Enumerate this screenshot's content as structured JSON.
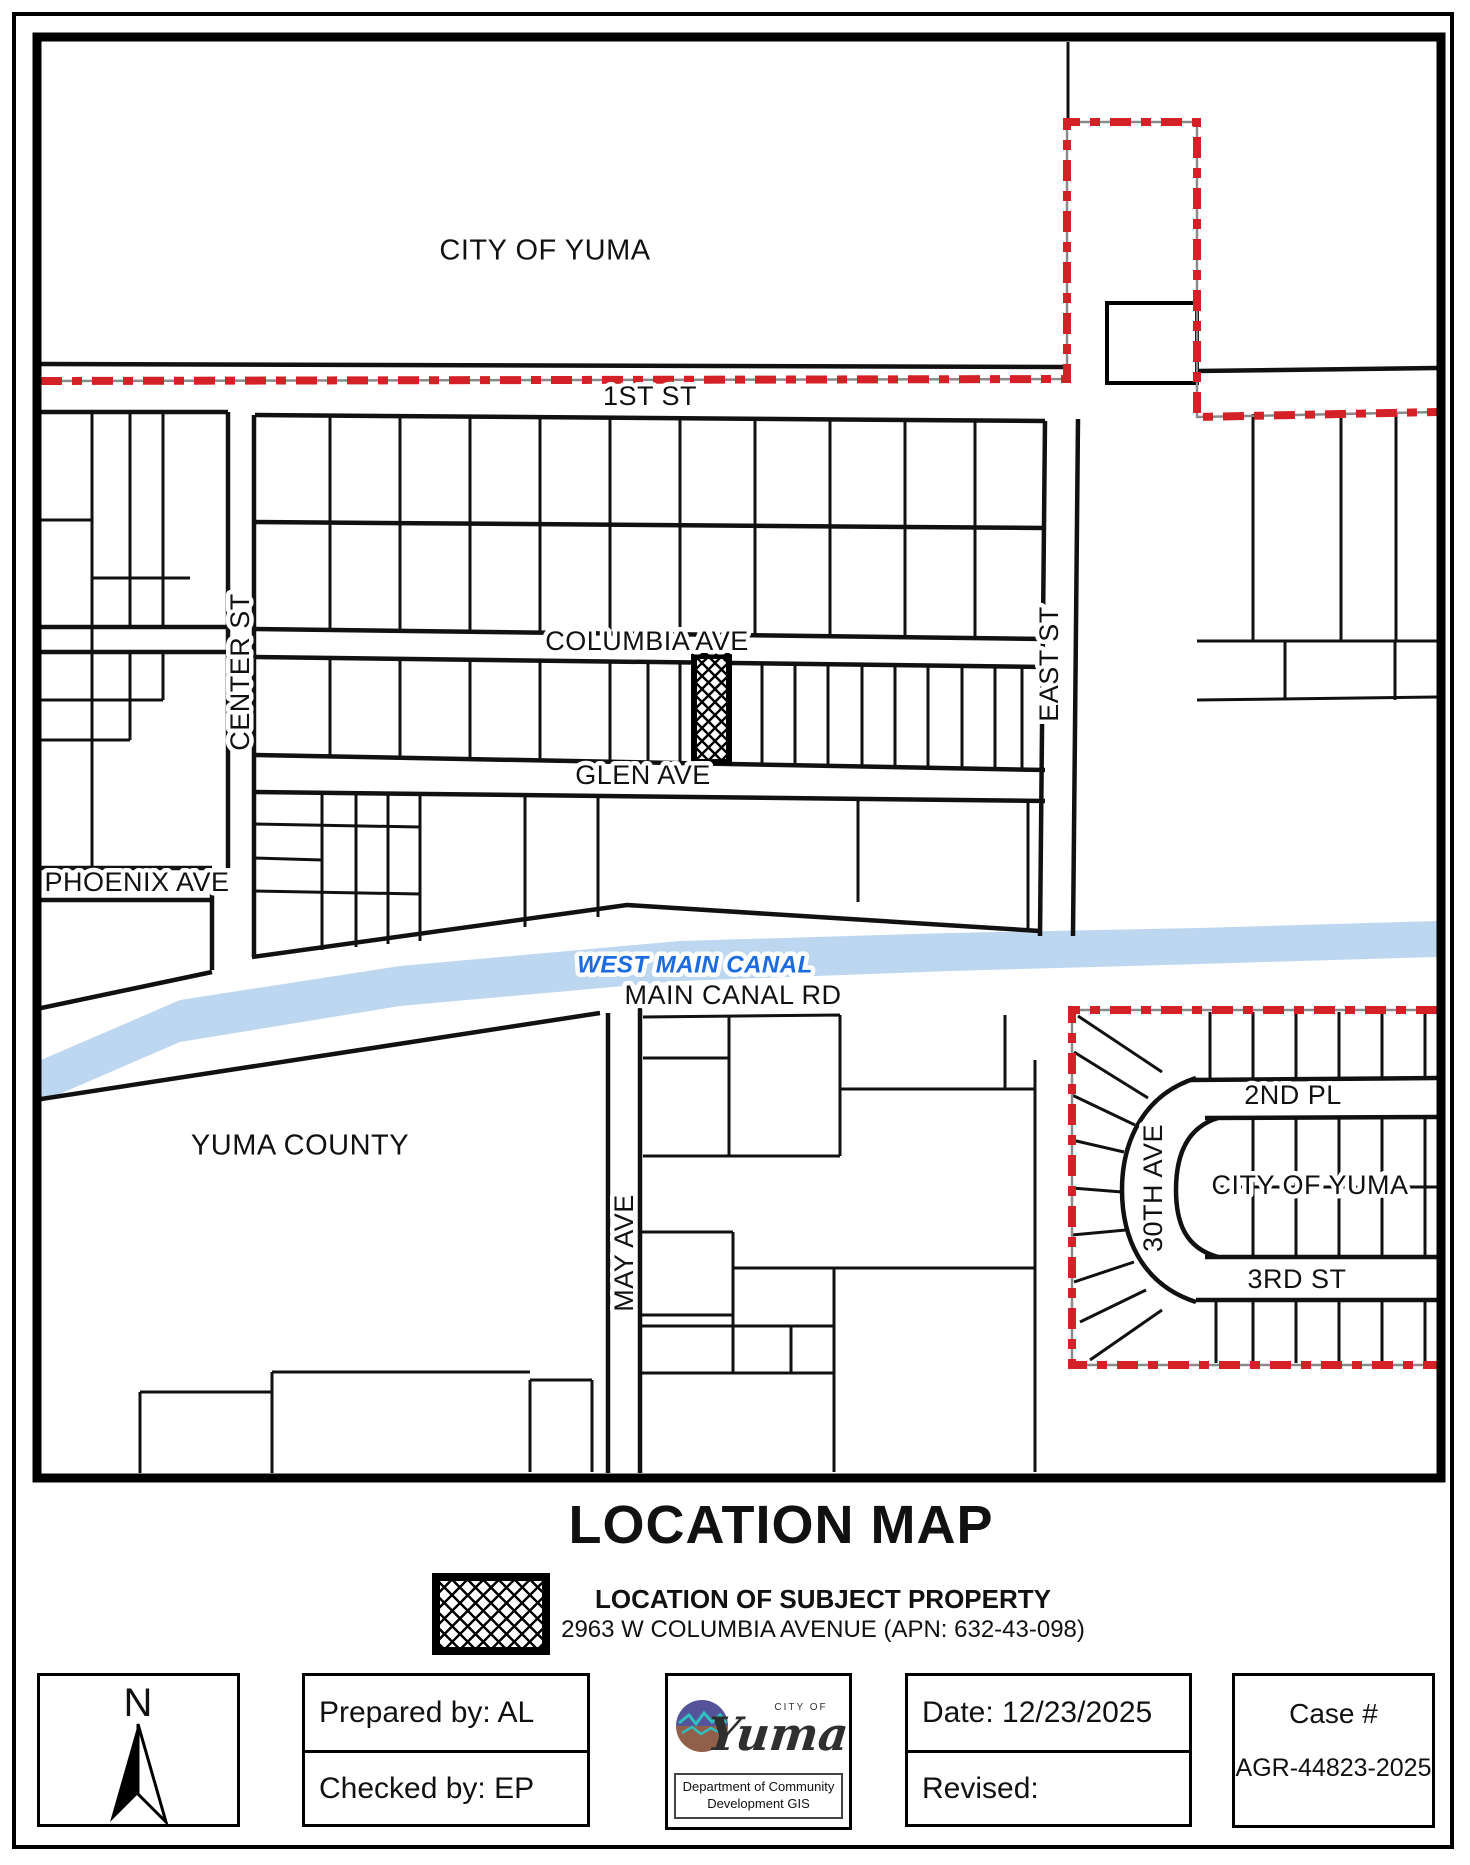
{
  "map": {
    "areas": {
      "city_of_yuma_top": "CITY OF YUMA",
      "yuma_county": "YUMA COUNTY",
      "city_of_yuma_subdivision": "CITY OF YUMA"
    },
    "streets": {
      "first_st": "1ST ST",
      "center_st": "CENTER ST",
      "columbia_ave": "COLUMBIA AVE",
      "glen_ave": "GLEN AVE",
      "phoenix_ave": "PHOENIX AVE",
      "east_st": "EAST ST",
      "main_canal_rd": "MAIN CANAL RD",
      "may_ave": "MAY AVE",
      "second_pl": "2ND PL",
      "thirtieth_ave": "30TH AVE",
      "third_st": "3RD ST"
    },
    "waterways": {
      "west_main_canal": "WEST MAIN CANAL"
    },
    "colors": {
      "boundary_red": "#d42127",
      "canal_fill_blue": "#bdd7f0",
      "canal_label_blue": "#1d6be0",
      "parcel_line_black": "#111111"
    }
  },
  "title": "LOCATION MAP",
  "legend": {
    "heading": "LOCATION OF SUBJECT PROPERTY",
    "address": "2963 W COLUMBIA AVENUE (APN: 632-43-098)"
  },
  "footer": {
    "north_arrow_label": "N",
    "prepared_by": "Prepared by:  AL",
    "checked_by": "Checked by:  EP",
    "logo": {
      "city_of": "CITY OF",
      "city_name": "Yuma",
      "department": "Department of Community Development GIS"
    },
    "date": "Date:  12/23/2025",
    "revised": "Revised:",
    "case_label": "Case #",
    "case_number": "AGR-44823-2025"
  }
}
